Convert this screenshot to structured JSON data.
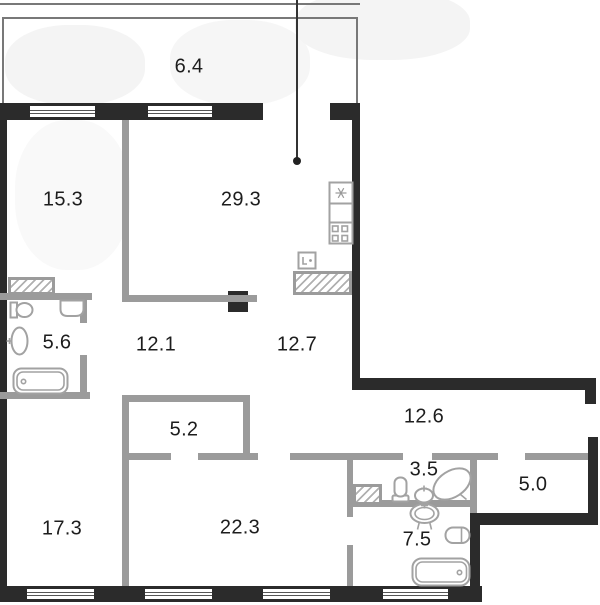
{
  "floor_plan": {
    "type": "apartment-floor-plan",
    "rooms": [
      {
        "id": "balcony",
        "area": "6.4"
      },
      {
        "id": "bedroom-top",
        "area": "15.3"
      },
      {
        "id": "living-kitchen",
        "area": "29.3"
      },
      {
        "id": "bathroom-left",
        "area": "5.6"
      },
      {
        "id": "hallway-left",
        "area": "12.1"
      },
      {
        "id": "hallway-right",
        "area": "12.7"
      },
      {
        "id": "corridor",
        "area": "12.6"
      },
      {
        "id": "wardrobe",
        "area": "5.2"
      },
      {
        "id": "wc",
        "area": "3.5"
      },
      {
        "id": "storage",
        "area": "5.0"
      },
      {
        "id": "bedroom-bottom-left",
        "area": "17.3"
      },
      {
        "id": "bedroom-bottom-mid",
        "area": "22.3"
      },
      {
        "id": "bathroom-right",
        "area": "7.5"
      }
    ],
    "colors": {
      "exterior_wall": "#2b2b2b",
      "interior_wall": "#9b9b9b",
      "fixture_outline": "#a2a2a2",
      "label_text": "#1d1d1d",
      "background": "#ffffff"
    },
    "icons": [
      "fridge-icon",
      "stove-icon",
      "kitchen-sink-icon",
      "toilet-icon",
      "washbasin-icon",
      "bathtub-icon",
      "corner-bathtub-icon",
      "pedestal-sink-icon",
      "water-heater-icon",
      "washing-machine-icon",
      "ventilation-shaft-icon",
      "leader-dot-icon"
    ]
  }
}
